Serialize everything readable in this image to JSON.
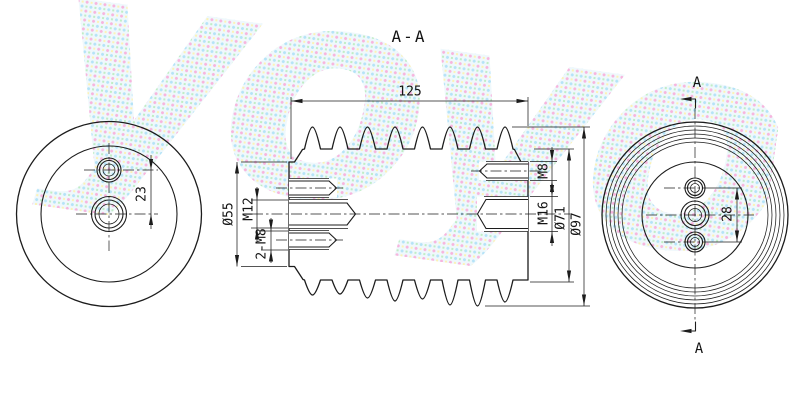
{
  "title": {
    "section_label": "A-A"
  },
  "watermark": {
    "text": "yoyo"
  },
  "left_view": {
    "hole_spacing_dim": "23"
  },
  "section_view": {
    "length_dim": "125",
    "core_diameter_dim": "Ø55",
    "left_center_thread_dim": "M12",
    "left_side_threads_dim": "2-M8",
    "right_top_thread_dim": "M8",
    "right_center_thread_dim": "M16",
    "shed_inner_diameter_dim": "Ø71",
    "shed_outer_diameter_dim": "Ø97"
  },
  "right_view": {
    "hole_spacing_dim": "28",
    "cutting_plane_top_label": "A",
    "cutting_plane_bottom_label": "A"
  },
  "colors": {
    "line": "#1c1c1c",
    "background": "#ffffff",
    "watermark_magenta": "#f06ebe",
    "watermark_cyan": "#6ec8f0",
    "watermark_yellow": "#fae66e",
    "watermark_green": "#82dc8c"
  }
}
